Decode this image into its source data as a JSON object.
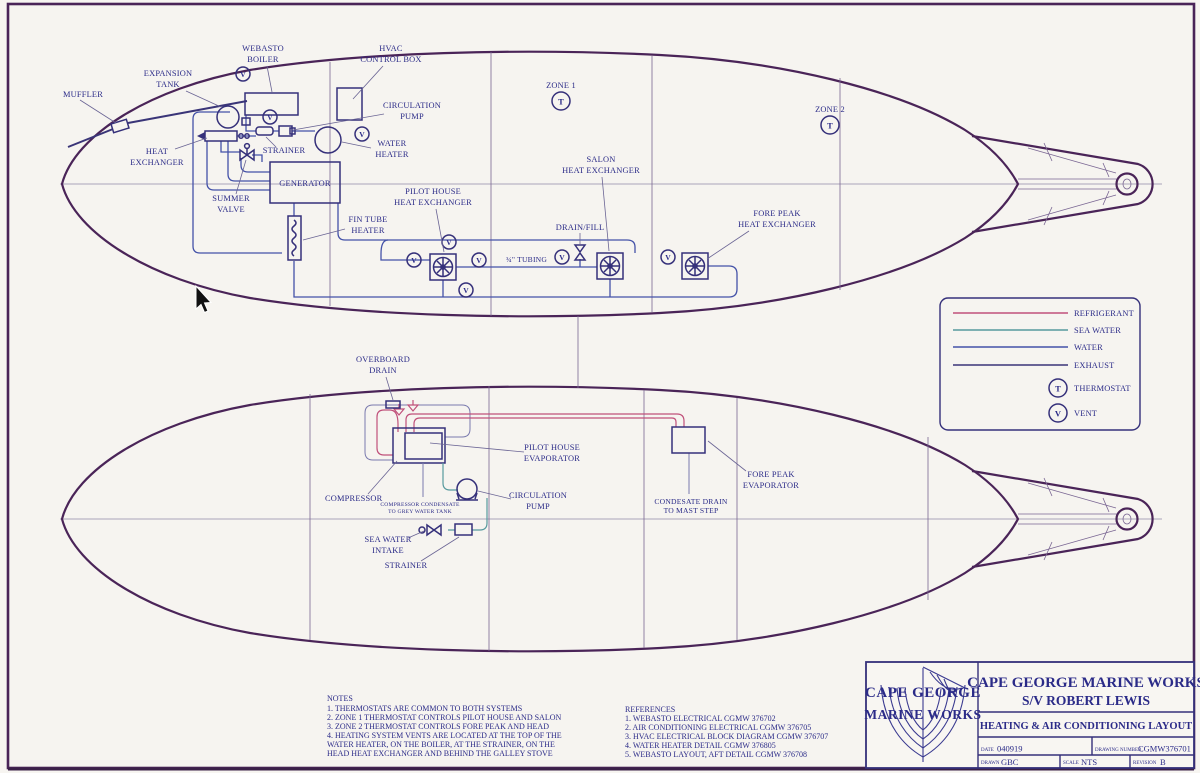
{
  "symbols": {
    "thermostat": "T",
    "vent": "V"
  },
  "top_view": {
    "zone1": "ZONE 1",
    "zone2": "ZONE 2",
    "muffler": "MUFFLER",
    "expansion_tank": [
      "EXPANSION",
      "TANK"
    ],
    "webasto_boiler": [
      "WEBASTO",
      "BOILER"
    ],
    "hvac_control_box": [
      "HVAC",
      "CONTROL BOX"
    ],
    "circulation_pump": [
      "CIRCULATION",
      "PUMP"
    ],
    "heat_exchanger": [
      "HEAT",
      "EXCHANGER"
    ],
    "strainer": "STRAINER",
    "water_heater": [
      "WATER",
      "HEATER"
    ],
    "generator": "GENERATOR",
    "summer_valve": [
      "SUMMER",
      "VALVE"
    ],
    "fin_tube_heater": [
      "FIN TUBE",
      "HEATER"
    ],
    "pilot_house_heat_exchanger": [
      "PILOT HOUSE",
      "HEAT EXCHANGER"
    ],
    "salon_heat_exchanger": [
      "SALON",
      "HEAT EXCHANGER"
    ],
    "fore_peak_heat_exchanger": [
      "FORE PEAK",
      "HEAT EXCHANGER"
    ],
    "drain_fill": "DRAIN/FILL",
    "tubing": "¾\" TUBING"
  },
  "bottom_view": {
    "overboard_drain": [
      "OVERBOARD",
      "DRAIN"
    ],
    "pilot_house_evaporator": [
      "PILOT HOUSE",
      "EVAPORATOR"
    ],
    "compressor": "COMPRESSOR",
    "compressor_condensate": [
      "COMPRESSOR CONDENSATE",
      "TO GREY WATER TANK"
    ],
    "circulation_pump": [
      "CIRCULATION",
      "PUMP"
    ],
    "sea_water_intake": [
      "SEA WATER",
      "INTAKE"
    ],
    "strainer": "STRAINER",
    "fore_peak_evaporator": [
      "FORE PEAK",
      "EVAPORATOR"
    ],
    "condensate_drain": [
      "CONDESATE DRAIN",
      "TO MAST STEP"
    ]
  },
  "legend": {
    "items": [
      {
        "label": "REFRIGERANT",
        "color": "#c0507a"
      },
      {
        "label": "SEA WATER",
        "color": "#579a9e"
      },
      {
        "label": "WATER",
        "color": "#4452a8"
      },
      {
        "label": "EXHAUST",
        "color": "#3a3578"
      }
    ],
    "thermostat_label": "THERMOSTAT",
    "vent_label": "VENT"
  },
  "notes": {
    "title": "NOTES",
    "lines": [
      "1. THERMOSTATS ARE COMMON TO BOTH SYSTEMS",
      "2. ZONE 1 THERMOSTAT CONTROLS PILOT HOUSE AND SALON",
      "3. ZONE 2 THERMOSTAT CONTROLS FORE PEAK AND HEAD",
      "4. HEATING SYSTEM VENTS ARE LOCATED AT THE TOP OF THE",
      "    WATER HEATER, ON THE BOILER, AT THE STRAINER, ON THE",
      "    HEAD HEAT EXCHANGER AND BEHIND THE GALLEY STOVE"
    ]
  },
  "references": {
    "title": "REFERENCES",
    "lines": [
      "1. WEBASTO ELECTRICAL CGMW 376702",
      "2. AIR CONDITIONING ELECTRICAL CGMW 376705",
      "3. HVAC ELECTRICAL BLOCK DIAGRAM CGMW 376707",
      "4. WATER HEATER DETAIL CGMW 376805",
      "5. WEBASTO LAYOUT, AFT DETAIL CGMW 376708"
    ]
  },
  "title_block": {
    "logo_top": "CAPE GEORGE",
    "logo_bottom": "MARINE WORKS",
    "company": "CAPE GEORGE MARINE WORKS",
    "vessel": "S/V ROBERT LEWIS",
    "drawing_title": "HEATING & AIR CONDITIONING LAYOUT",
    "date_label": "DATE",
    "date_value": "040919",
    "drawing_number_label": "DRAWING NUMBER",
    "drawing_number_value": "CGMW376701",
    "drawn_label": "DRAWN",
    "drawn_value": "GBC",
    "scale_label": "SCALE",
    "scale_value": "NTS",
    "revision_label": "REVISION",
    "revision_value": "B"
  }
}
